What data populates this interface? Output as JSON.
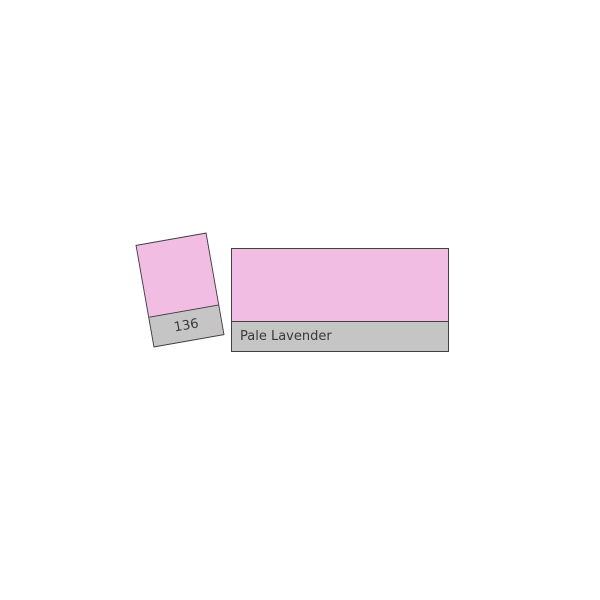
{
  "product": {
    "filter_number": "136",
    "filter_name": "Pale Lavender"
  },
  "colors": {
    "swatch_pink": "#F2BDE2",
    "label_gray": "#C5C5C5",
    "border": "#404040",
    "text": "#3A3A3A",
    "background": "#FFFFFF"
  }
}
